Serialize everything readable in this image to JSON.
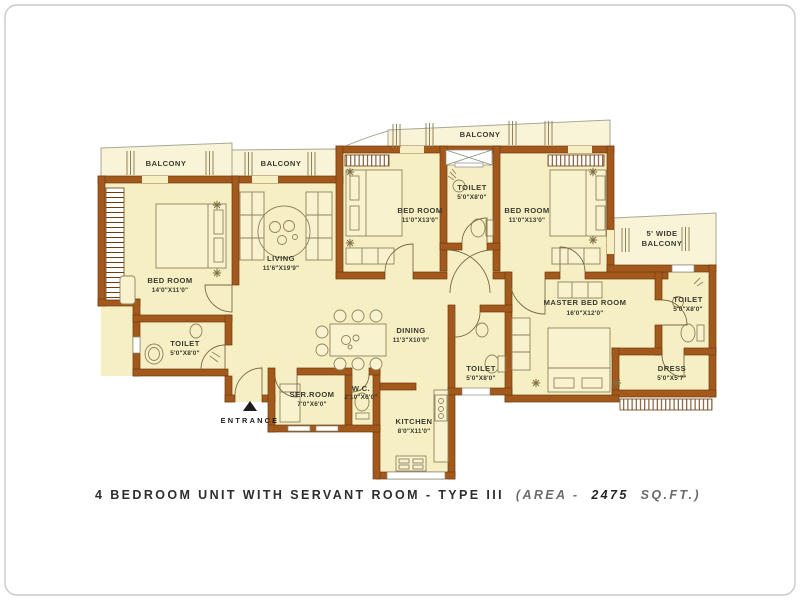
{
  "caption": {
    "main": "4 BEDROOM UNIT WITH SERVANT ROOM - TYPE III",
    "area_prefix": "(AREA  -",
    "area_value": "2475",
    "area_suffix": "SQ.FT.)"
  },
  "entrance": {
    "label": "ENTRANCE"
  },
  "colors": {
    "wall": "#A4591C",
    "floor": "#F6EFC3",
    "balcony": "#F9F4D8",
    "label_text": "#3a3a30"
  },
  "rooms": {
    "balcony_left": {
      "name": "BALCONY"
    },
    "balcony_left2": {
      "name": "BALCONY"
    },
    "balcony_top": {
      "name": "BALCONY"
    },
    "balcony_right": {
      "name": "5' WIDE",
      "name2": "BALCONY"
    },
    "bedroom_left": {
      "name": "BED ROOM",
      "size": "14'0\"X11'0\""
    },
    "living": {
      "name": "LIVING",
      "size": "11'6\"X19'9\""
    },
    "bedroom_mid": {
      "name": "BED ROOM",
      "size": "11'0\"X13'0\""
    },
    "toilet_top": {
      "name": "TOILET",
      "size": "5'0\"X8'0\""
    },
    "bedroom_right": {
      "name": "BED ROOM",
      "size": "11'0\"X13'0\""
    },
    "master_bedroom": {
      "name": "MASTER BED ROOM",
      "size": "16'0\"X12'0\""
    },
    "toilet_right": {
      "name": "TOILET",
      "size": "5'0\"X8'0\""
    },
    "dress": {
      "name": "DRESS",
      "size": "5'0\"X5'7\""
    },
    "toilet_left": {
      "name": "TOILET",
      "size": "5'0\"X8'0\""
    },
    "dining": {
      "name": "DINING",
      "size": "11'3\"X10'0\""
    },
    "toilet_mid": {
      "name": "TOILET",
      "size": "5'0\"X8'0\""
    },
    "servant_room": {
      "name": "SER.ROOM",
      "size": "7'0\"X6'0\""
    },
    "wc": {
      "name": "W.C.",
      "size": "2'10\"X6'0\""
    },
    "kitchen": {
      "name": "KITCHEN",
      "size": "8'0\"X11'0\""
    }
  }
}
